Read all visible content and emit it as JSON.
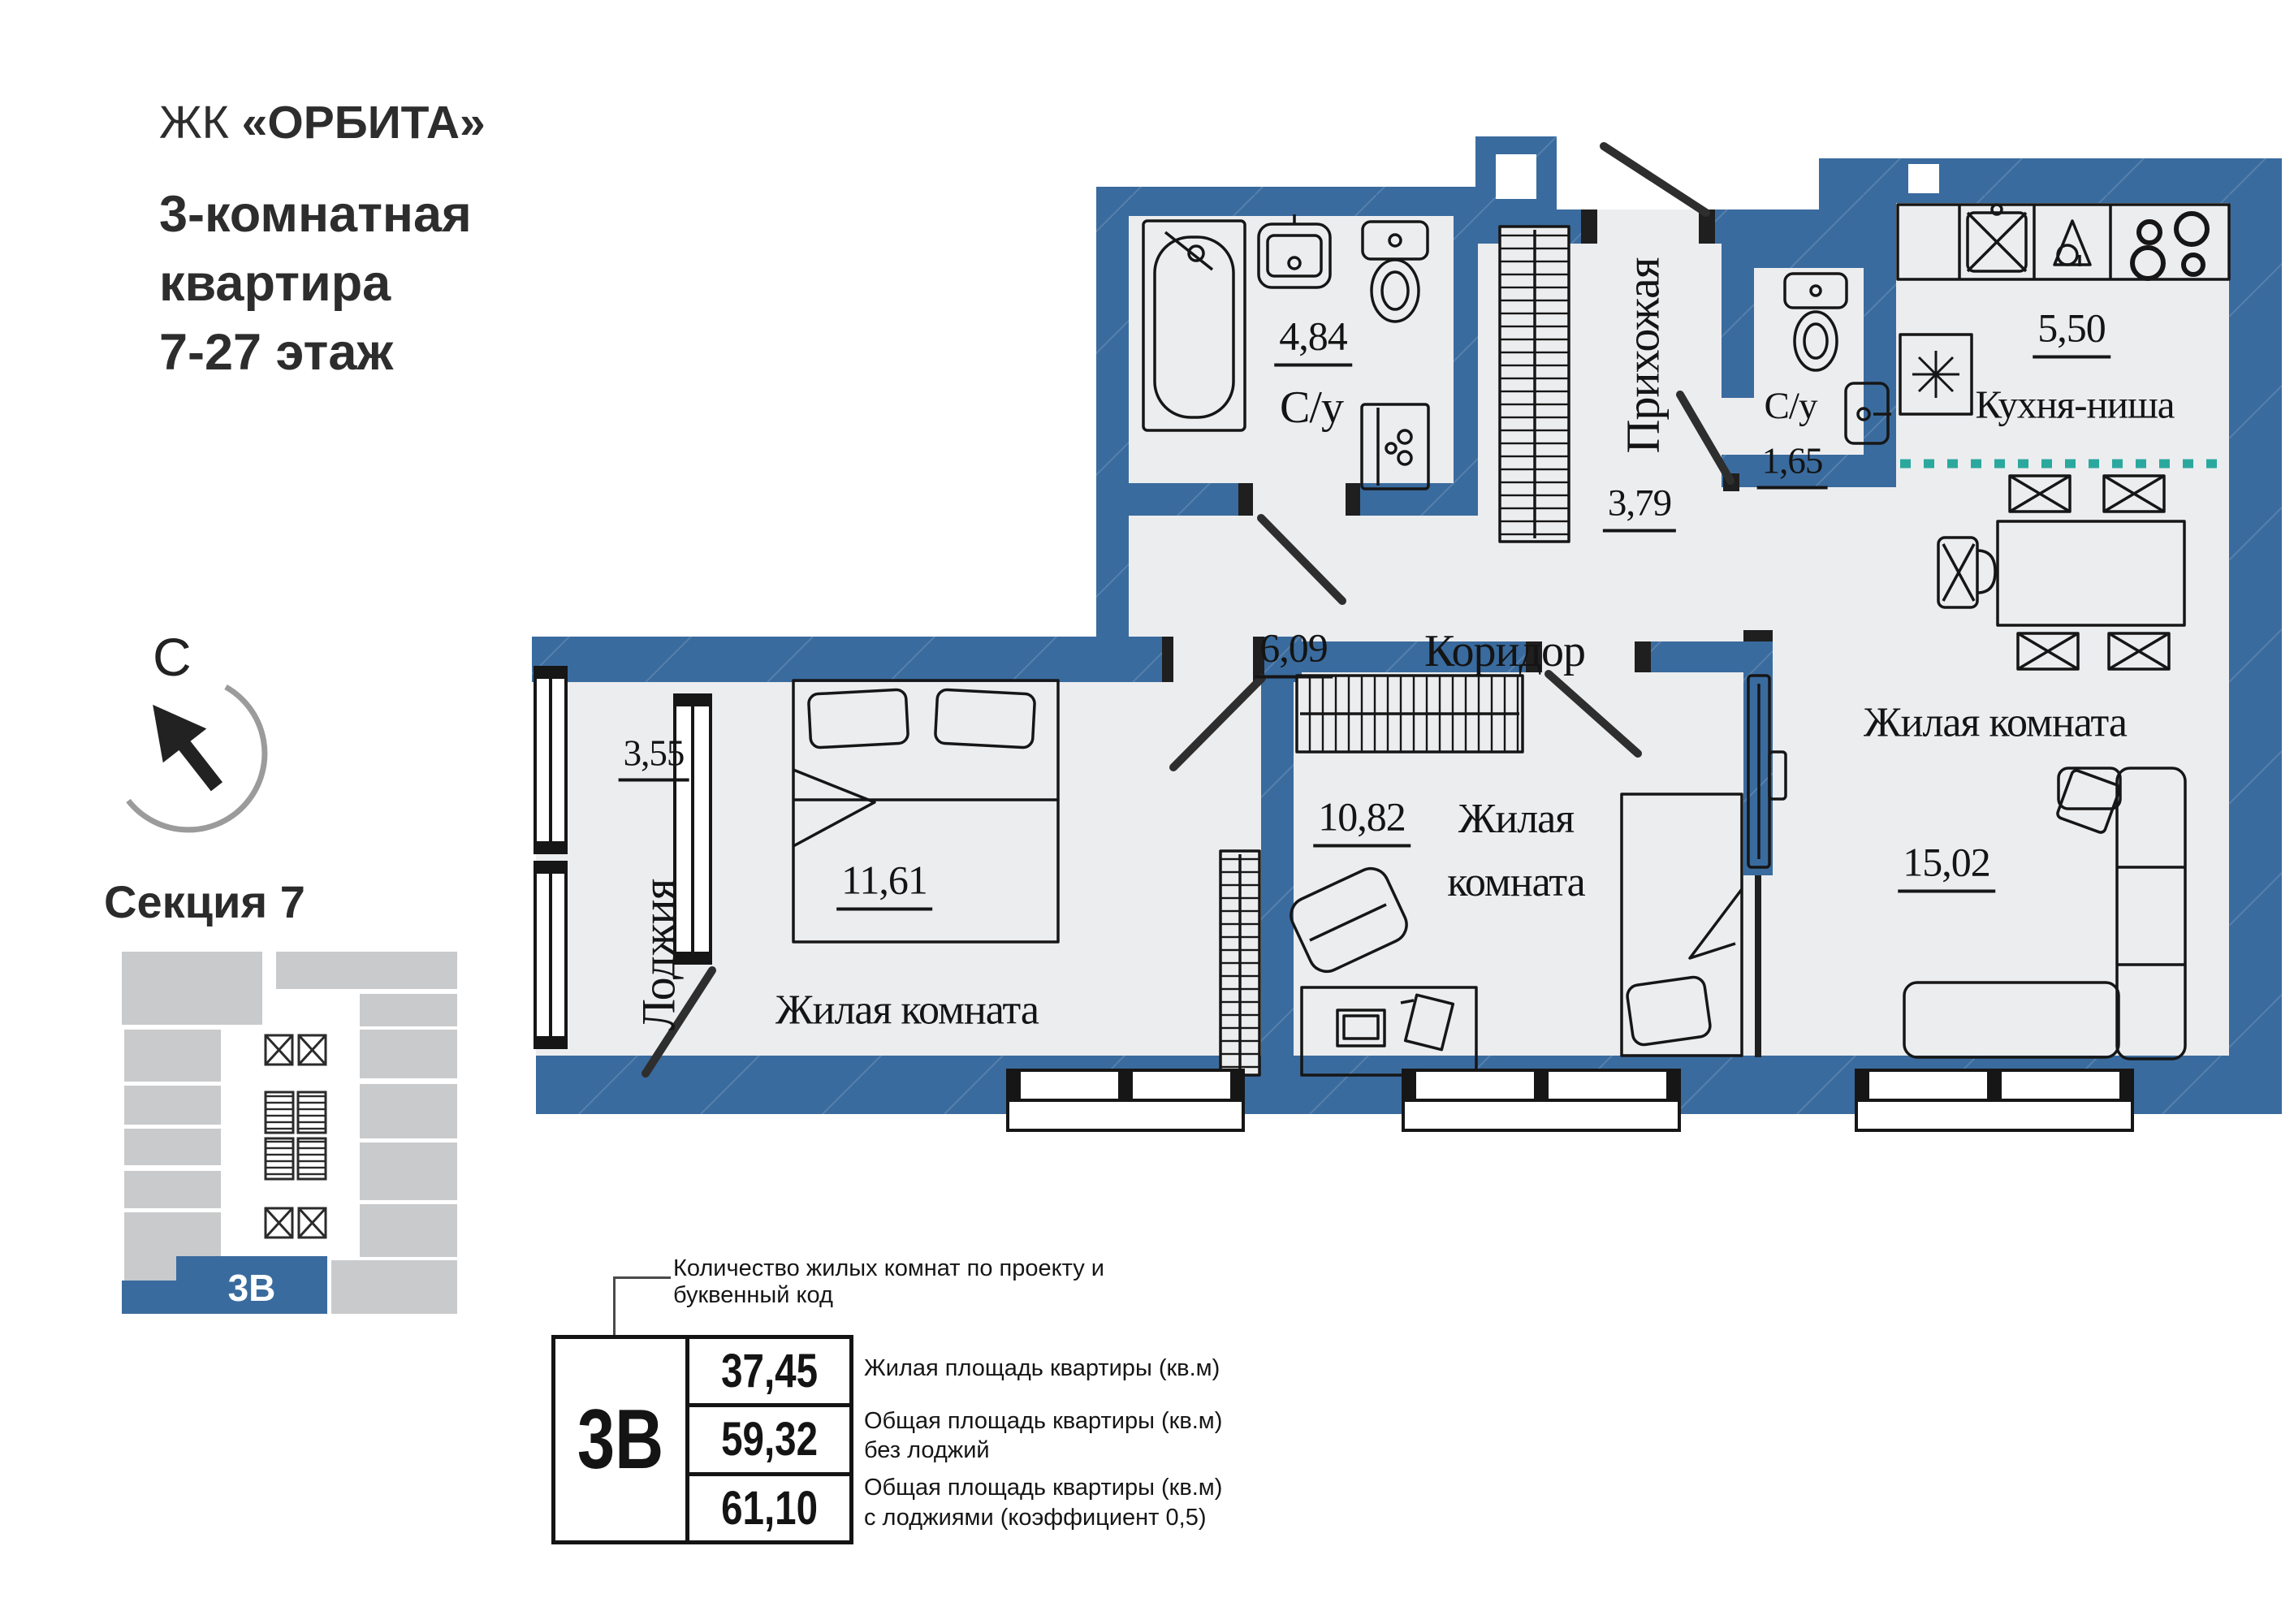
{
  "header": {
    "complex_prefix": "ЖК ",
    "complex_name": "«ОРБИТА»",
    "line1": "3-комнатная",
    "line2": "квартира",
    "line3": "7-27 этаж"
  },
  "compass": {
    "north_label": "С"
  },
  "section": {
    "title": "Секция 7",
    "unit_code": "3В"
  },
  "plan": {
    "rooms": {
      "bathroom_main": {
        "name": "С/у",
        "area": "4,84"
      },
      "hallway": {
        "name": "Прихожая",
        "area": "3,79"
      },
      "bathroom_small": {
        "name": "С/у",
        "area": "1,65"
      },
      "kitchen": {
        "name": "Кухня-ниша",
        "area": "5,50"
      },
      "corridor": {
        "name": "Коридор",
        "area": "6,09"
      },
      "loggia": {
        "name": "Лоджия",
        "area": "3,55"
      },
      "bedroom_1": {
        "name": "Жилая комната",
        "area": "11,61"
      },
      "bedroom_2": {
        "name": "Жилая комната",
        "area": "10,82"
      },
      "living_room": {
        "name": "Жилая комната",
        "area": "15,02"
      }
    }
  },
  "legend": {
    "callout": "Количество жилых комнат по проекту и буквенный код",
    "unit_code": "3В",
    "rows": [
      {
        "value": "37,45",
        "desc_line1": "Жилая площадь квартиры (кв.м)",
        "desc_line2": ""
      },
      {
        "value": "59,32",
        "desc_line1": "Общая площадь квартиры (кв.м)",
        "desc_line2": "без лоджий"
      },
      {
        "value": "61,10",
        "desc_line1": "Общая площадь квартиры (кв.м)",
        "desc_line2": "с лоджиями (коэффициент 0,5)"
      }
    ]
  },
  "colors": {
    "wall": "#3A6B9E",
    "floor": "#ECEDEF",
    "accent_teal": "#2BA89E",
    "map_gray": "#C9CACB"
  }
}
